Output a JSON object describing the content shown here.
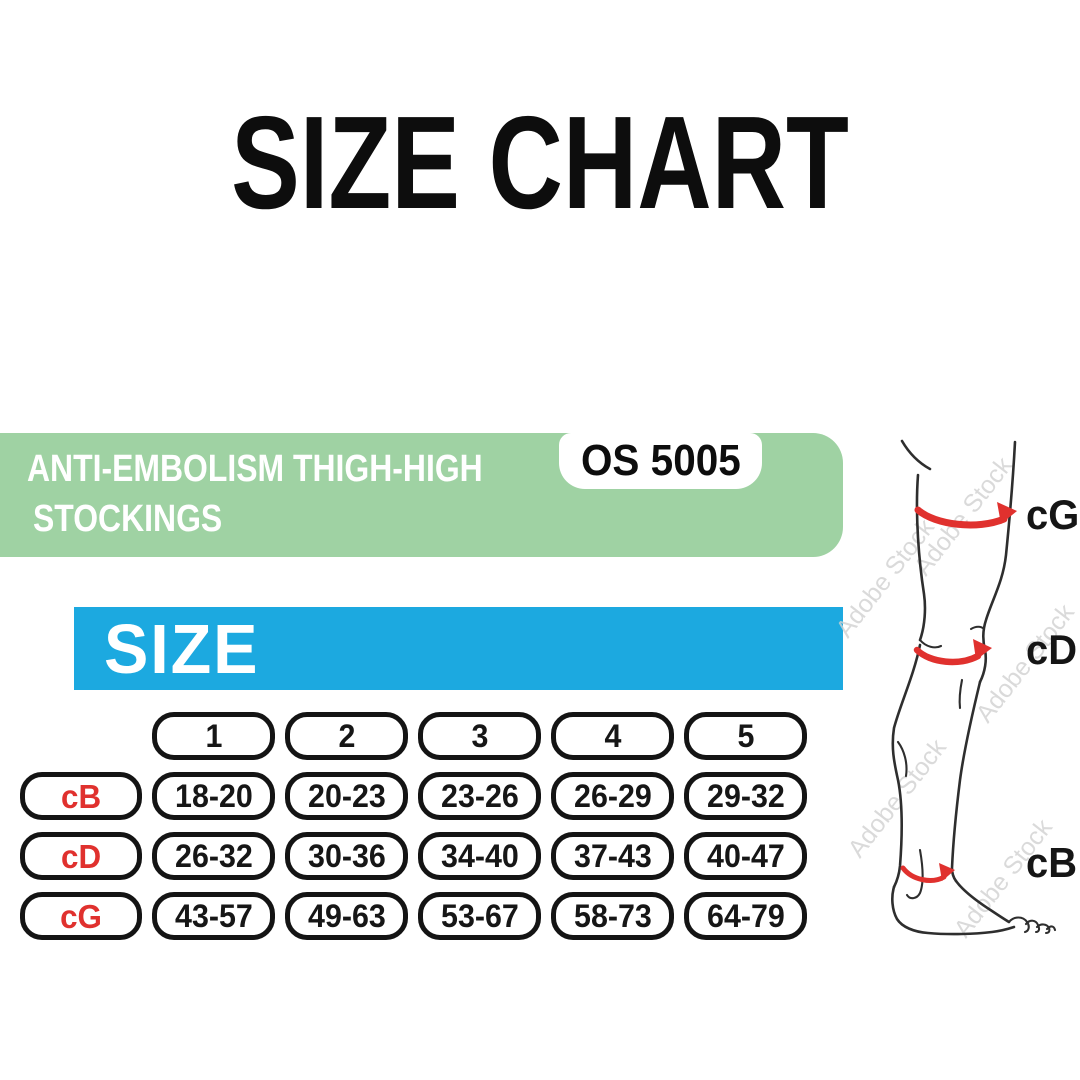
{
  "title": "SIZE CHART",
  "product_banner": {
    "line1": "ANTI-EMBOLISM THIGH-HIGH",
    "line2": "STOCKINGS",
    "model_code": "OS 5005"
  },
  "size_header": {
    "label": "SIZE"
  },
  "chart_data": {
    "type": "table",
    "title": "SIZE",
    "columns": [
      "1",
      "2",
      "3",
      "4",
      "5"
    ],
    "rows": [
      {
        "label": "cB",
        "values": [
          "18-20",
          "20-23",
          "23-26",
          "26-29",
          "29-32"
        ]
      },
      {
        "label": "cD",
        "values": [
          "26-32",
          "30-36",
          "34-40",
          "37-43",
          "40-47"
        ]
      },
      {
        "label": "cG",
        "values": [
          "43-57",
          "49-63",
          "53-67",
          "58-73",
          "64-79"
        ]
      }
    ]
  },
  "leg_diagram": {
    "labels": {
      "thigh": "cG",
      "knee": "cD",
      "ankle": "cB"
    },
    "watermark": "Adobe Stock"
  },
  "colors": {
    "banner_green": "#9fd2a3",
    "size_blue": "#1ca9e0",
    "accent_red": "#e0312e",
    "pill_border": "#141414"
  }
}
